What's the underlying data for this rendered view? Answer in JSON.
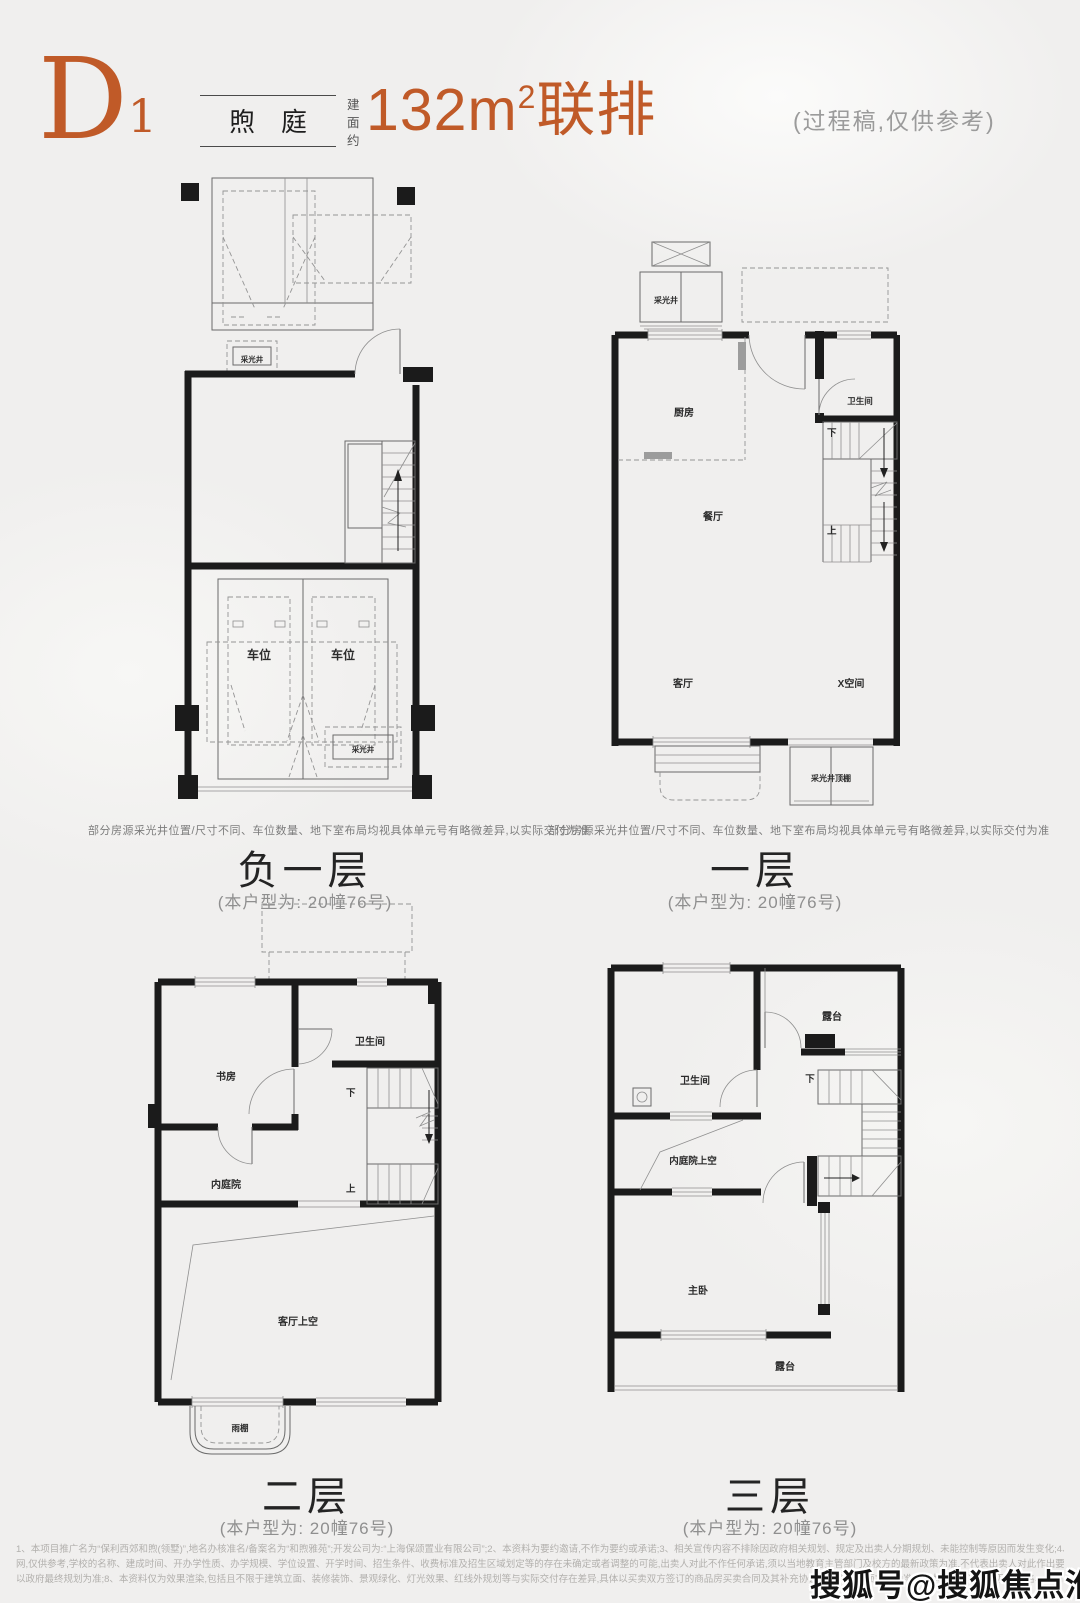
{
  "page": {
    "background": "#f0efee",
    "accent_color": "#c05a28",
    "wall_color": "#1b1b1b"
  },
  "header": {
    "plan_code": "D",
    "plan_code_sub": "1",
    "name_tag": "煦庭",
    "area_prefix": "建面约",
    "area_value": "132m",
    "area_sup": "2",
    "area_suffix": "联排",
    "note": "(过程稿,仅供参考)"
  },
  "floors": [
    {
      "title": "负一层",
      "subtitle": "(本户型为: 20幢76号)",
      "disclaimer": "部分房源采光井位置/尺寸不同、车位数量、地下室布局均视具体单元号有略微差异,以实际交付为准",
      "labels": {
        "light_well_top": "采光井",
        "parking": "车位",
        "light_well_bottom": "采光井"
      }
    },
    {
      "title": "一层",
      "subtitle": "(本户型为: 20幢76号)",
      "disclaimer": "部分房源采光井位置/尺寸不同、车位数量、地下室布局均视具体单元号有略微差异,以实际交付为准",
      "labels": {
        "light_well": "采光井",
        "kitchen": "厨房",
        "bathroom": "卫生间",
        "down": "下",
        "up": "上",
        "dining": "餐厅",
        "living": "客厅",
        "x_space": "X空间",
        "light_well_canopy": "采光井顶棚"
      }
    },
    {
      "title": "二层",
      "subtitle": "(本户型为: 20幢76号)",
      "labels": {
        "study": "书房",
        "bathroom": "卫生间",
        "down": "下",
        "up": "上",
        "courtyard": "内庭院",
        "living_void": "客厅上空",
        "canopy": "雨棚"
      }
    },
    {
      "title": "三层",
      "subtitle": "(本户型为: 20幢76号)",
      "labels": {
        "terrace_top": "露台",
        "bathroom": "卫生间",
        "down": "下",
        "courtyard_void": "内庭院上空",
        "master_bedroom": "主卧",
        "terrace_bottom": "露台"
      }
    }
  ],
  "footnotes": {
    "line1": "1、本项目推广名为“保利西郊和煦(领墅)”,地名办核准名/备案名为“和煦雅苑”;开发公司为:“上海保颂置业有限公司”;2、本资料为要约邀请,不作为要约或承诺;3、相关宣传内容不排除因政府相关规划、规定及出卖人分期规划、未能控制等原因而发生变化;4、买卖双方的权利义务以双方签订的商品房买卖合同及其补充协议、附件等书面文件为准;5、本资料所发布的内容为2025年04月前的信息,敬请留意最新资料;6、教育配套信息来源于政府官",
    "line2": "网,仅供参考,学校的名称、建成时间、开办学性质、办学规模、学位设置、开学时间、招生条件、收费标准及招生区域划定等的存在未确定或者调整的可能,出卖人对此不作任何承诺,须以当地教育主管部门及校方的最新政策为准,不代表出卖人对此作出要约或承诺;7、交通配套信息来源于政府官网数据,市政配套信息来源于政府官网数据,仅供参考,交通规划设置、市政配套设施",
    "line3": "以政府最终规划为准;8、本资料仅为效果渲染,包括且不限于建筑立面、装修装饰、景观绿化、灯光效果、红线外规划等与实际交付存在差异,具体以买卖双方签订的商品房买卖合同及其补充协议、附件等书面文件为准;9、本宣传资料中涉及的价格、折扣、付款方式等信息,因销售时间、户型结构、楼层、方位等不同有所差异,具体以实际为准。"
  },
  "watermark": "搜狐号@搜狐焦点淮南站"
}
